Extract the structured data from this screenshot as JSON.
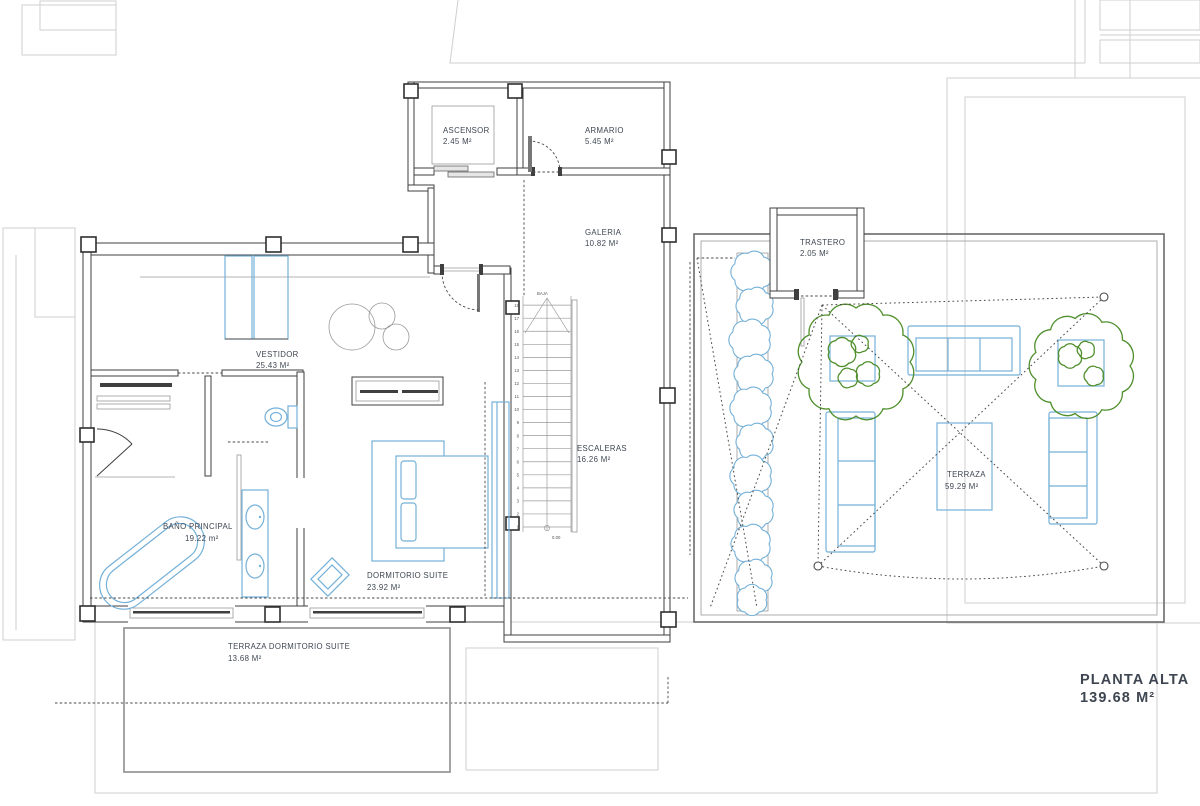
{
  "plan": {
    "title": {
      "name": "PLANTA ALTA",
      "area": "139.68 M²"
    },
    "rooms": {
      "ascensor": {
        "name": "ASCENSOR",
        "area": "2.45 M²"
      },
      "armario": {
        "name": "ARMARIO",
        "area": "5.45 M²"
      },
      "galeria": {
        "name": "GALERIA",
        "area": "10.82 M²"
      },
      "trastero": {
        "name": "TRASTERO",
        "area": "2.05 M²"
      },
      "vestidor": {
        "name": "VESTIDOR",
        "area": "25.43 M²"
      },
      "escaleras": {
        "name": "ESCALERAS",
        "area": "16.26 M²"
      },
      "bano_principal": {
        "name": "BAÑO  PRINCIPAL",
        "area": "19.22 m²"
      },
      "dormitorio_suite": {
        "name": "DORMITORIO SUITE",
        "area": "23.92 M²"
      },
      "terraza": {
        "name": "TERRAZA",
        "area": "59.29 M²"
      },
      "terraza_dormitorio": {
        "name": "TERRAZA DORMITORIO SUITE",
        "area": "13.68 M²"
      }
    },
    "stairs": {
      "direction_label": "BAJA",
      "level_mark": "0.00",
      "steps": [
        "1",
        "2",
        "3",
        "4",
        "5",
        "6",
        "7",
        "8",
        "9",
        "10",
        "11",
        "12",
        "13",
        "14",
        "15",
        "16",
        "17",
        "18"
      ]
    },
    "colors": {
      "wall": "#3f3f3f",
      "blue": "#74b0d8",
      "green": "#4f8f2c",
      "gray": "#cfcfcf",
      "label": "#3e4651"
    }
  }
}
